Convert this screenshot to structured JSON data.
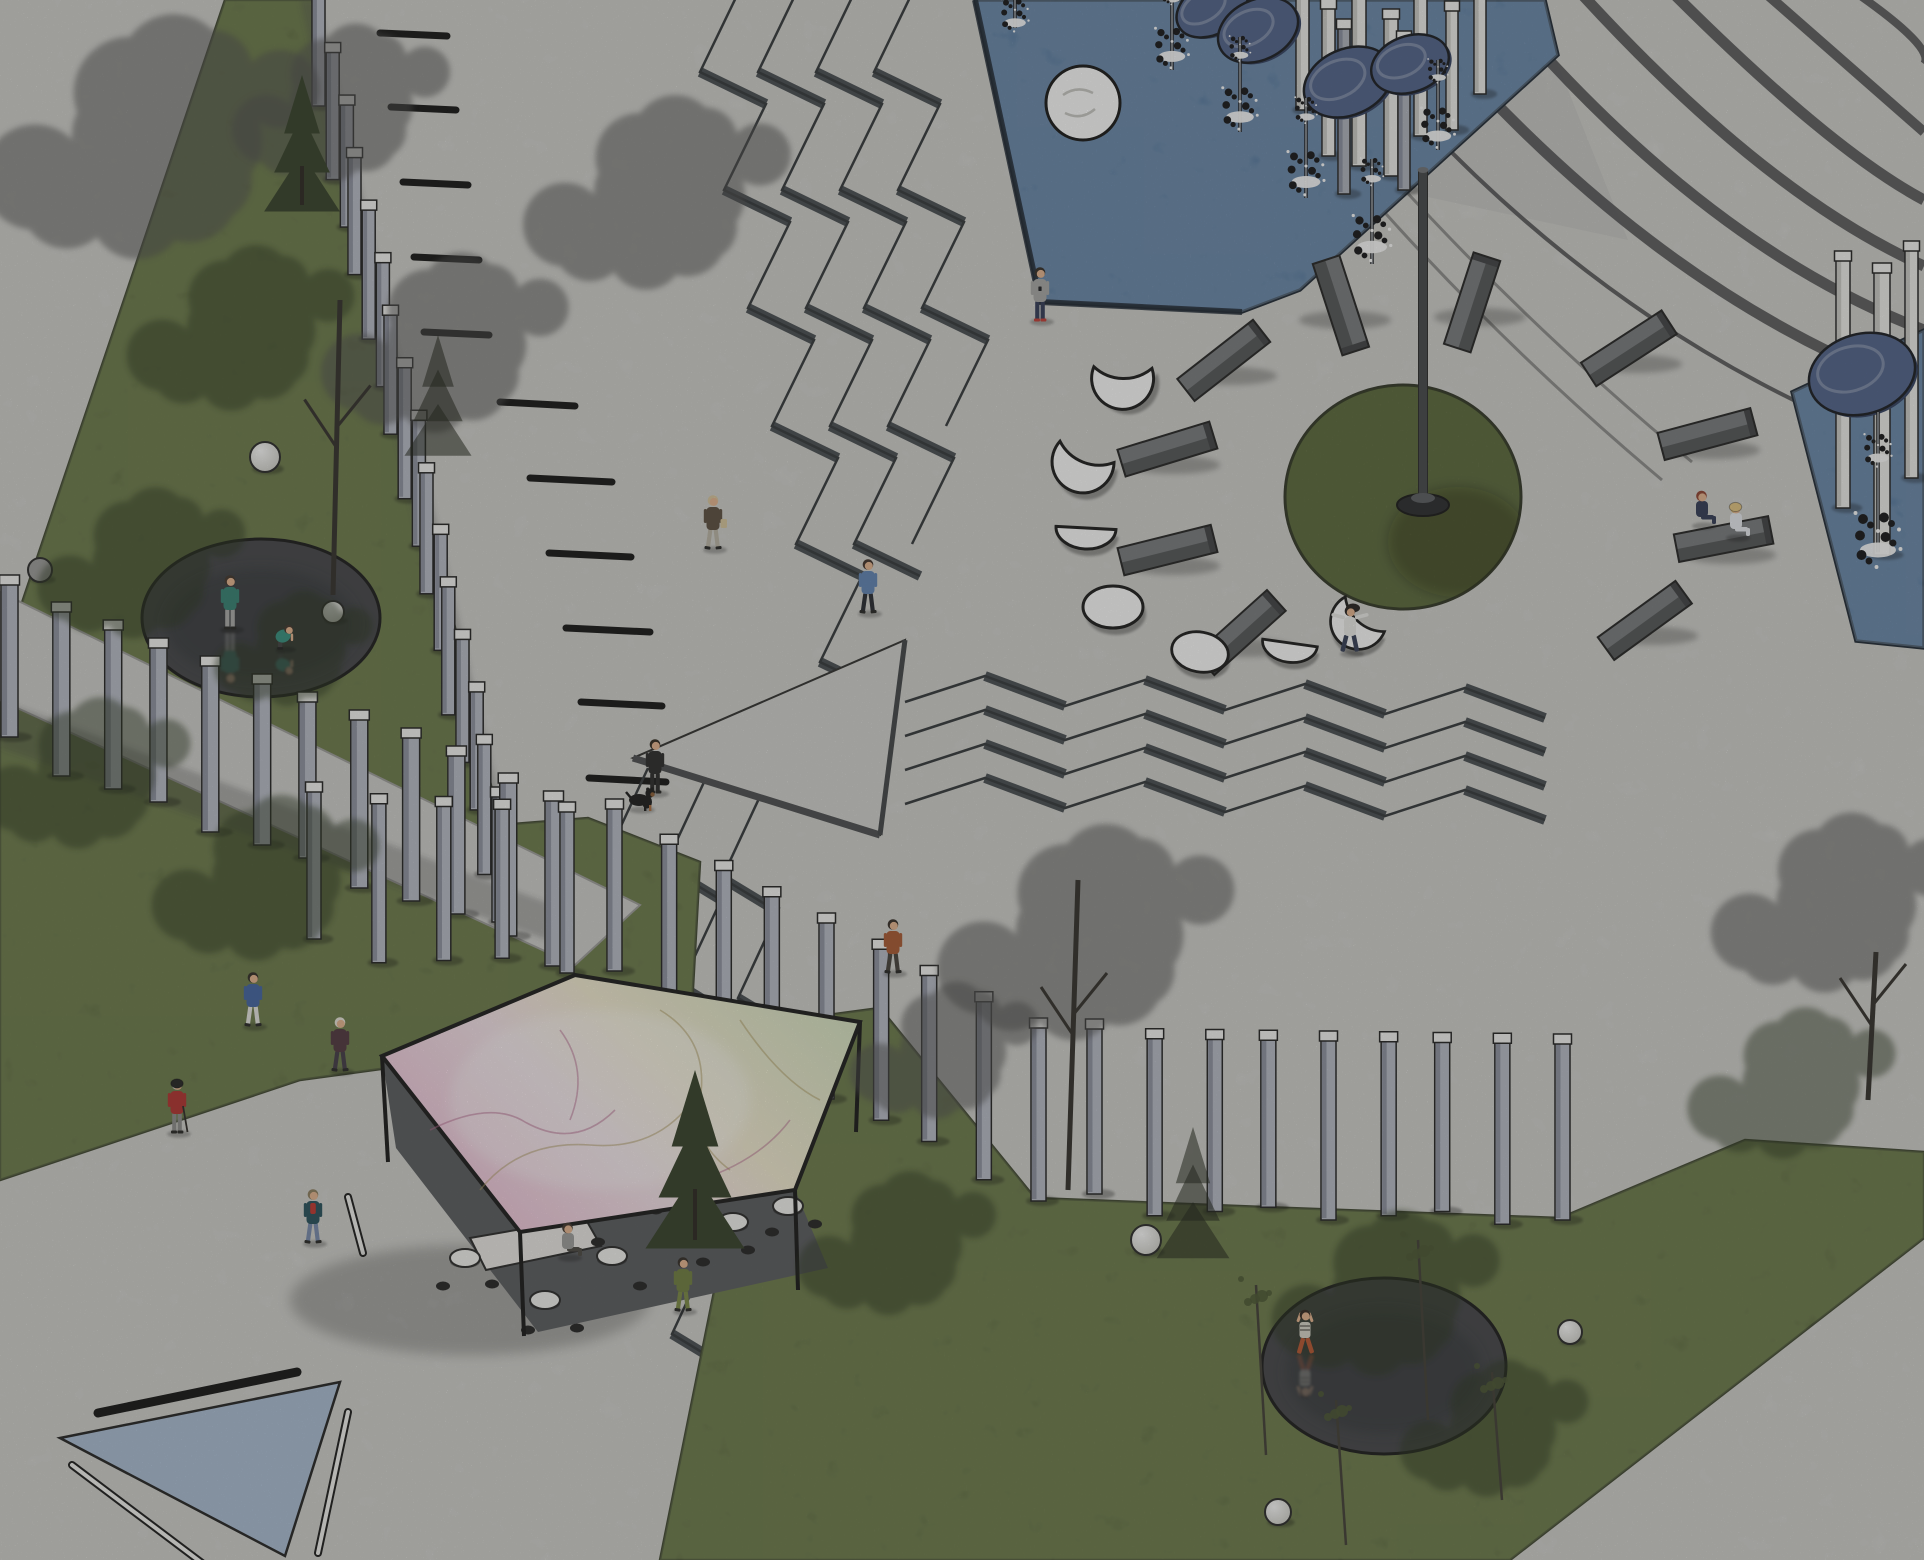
{
  "scene": {
    "title": "Plaza site plan — axonometric illustration",
    "description": "Axonometric architectural rendering of a public plaza: triangular lawns with reflective circular ponds, rows of slab bollards, zig-zag stairs, a blue fountain pool with circular mirrors on posts, a sundial lawn circle with a tall mast surrounded by stone benches and white moon-phase sculptures, and a pentagonal pavilion with an iridescent roof.",
    "canvas": {
      "w": 1924,
      "h": 1560
    }
  },
  "palette": {
    "concrete": "#d9d9d6",
    "concrete_mottle": "#c6c6c2",
    "lawn": "#6f7f49",
    "lawn_dark": "#4e5c34",
    "lawn_edge": "#39402a",
    "pool_blue": "#5780b2",
    "pool_edge": "#18222f",
    "pond_dark": "#3e3f43",
    "pond_edge": "#141414",
    "pillar": "#b7bbc7",
    "pillar_side": "#868b9a",
    "pillar_cap": "#f6f6f4",
    "white_slab": "#efefec",
    "white_slab_side": "#c7c7c3",
    "bench_front": "#4e5052",
    "bench_top": "#75787b",
    "bench_end": "#3a3c3e",
    "moon_white": "#ffffff",
    "outline": "#161616",
    "disc_blue": "#4b5e88",
    "disc_rim": "#2c3a5c",
    "mast": "#3f4144",
    "stair_line": "#2d3135",
    "stair_riser": "#42474c",
    "band_dark": "#4d4d4f",
    "dash_black": "#0d0d0d",
    "roof_pink": "#f1bed8",
    "roof_cream": "#f4ecd2",
    "roof_green": "#d9e5c3",
    "path_band": "#cfcfcc",
    "triangle_blue": "#a9bdd4",
    "skin": "#e7b38c",
    "canopy_gray": "#4a4a48",
    "canopy_green": "#222d14"
  },
  "ground": {
    "lawn_topleft": "225,0 312,0 500,825 588,818 700,862 692,1006 560,1012 432,1062 300,1080 0,1180 0,668",
    "lawn_bottomright": "695,1155 790,1020 880,1008 1035,1198 1290,1208 1560,1218 1745,1140 1924,1152 1924,1238 1510,1560 660,1560 718,1272",
    "lawn_circle": {
      "cx": 1403,
      "cy": 497,
      "rx": 118,
      "ry": 112
    },
    "path_band": "0,592 0,700 575,965 640,905",
    "triangle_blue": "60,1438 340,1382 285,1556",
    "black_bar": [
      98,
      1413,
      297,
      1372
    ],
    "white_rods": [
      [
        348,
        1197,
        363,
        1253
      ],
      [
        318,
        1553,
        348,
        1412
      ],
      [
        72,
        1465,
        210,
        1569
      ]
    ]
  },
  "markings": {
    "dashes": [
      [
        380,
        33,
        447,
        36
      ],
      [
        391,
        107,
        456,
        110
      ],
      [
        403,
        182,
        468,
        185
      ],
      [
        414,
        257,
        479,
        260
      ],
      [
        424,
        332,
        489,
        335
      ],
      [
        500,
        402,
        575,
        406
      ],
      [
        530,
        478,
        612,
        482
      ],
      [
        549,
        553,
        631,
        557
      ],
      [
        566,
        628,
        650,
        632
      ],
      [
        581,
        702,
        662,
        706
      ],
      [
        589,
        778,
        666,
        782
      ],
      [
        597,
        853,
        667,
        857
      ],
      [
        612,
        928,
        681,
        932
      ]
    ],
    "curved_bands": [
      [
        "M1310,-10 Q1570,330 1924,455",
        4
      ],
      [
        "M1395,-10 Q1640,290 1924,392",
        11
      ],
      [
        "M1487,-10 Q1700,245 1924,330",
        11
      ],
      [
        "M1578,-10 Q1765,195 1924,266",
        11
      ],
      [
        "M1670,-10 Q1830,150 1924,200",
        11
      ],
      [
        "M1762,-10 Q1888,100 1924,132",
        10
      ],
      [
        "M1852,-10 Q1936,48 1924,64",
        8
      ]
    ],
    "thin_lines": [
      [
        "M1205,-10 Q1400,260 1662,480",
        3
      ],
      [
        "M1238,-10 Q1430,245 1692,462",
        3
      ]
    ],
    "walkway_shade": "1290,0 1532,0 1628,240 1386,188"
  },
  "stairs": {
    "vertical": [
      [
        [
          742,
          -15
        ],
        [
          700,
          72
        ],
        [
          766,
          104
        ],
        [
          724,
          190
        ],
        [
          790,
          222
        ],
        [
          748,
          308
        ],
        [
          814,
          340
        ],
        [
          772,
          426
        ],
        [
          838,
          458
        ],
        [
          796,
          544
        ],
        [
          862,
          576
        ],
        [
          820,
          662
        ],
        [
          886,
          694
        ]
      ],
      [
        [
          800,
          -15
        ],
        [
          758,
          72
        ],
        [
          824,
          104
        ],
        [
          782,
          190
        ],
        [
          848,
          222
        ],
        [
          806,
          308
        ],
        [
          872,
          340
        ],
        [
          830,
          426
        ],
        [
          896,
          458
        ],
        [
          854,
          544
        ],
        [
          920,
          576
        ]
      ],
      [
        [
          858,
          -15
        ],
        [
          816,
          72
        ],
        [
          882,
          104
        ],
        [
          840,
          190
        ],
        [
          906,
          222
        ],
        [
          864,
          308
        ],
        [
          930,
          340
        ],
        [
          888,
          426
        ],
        [
          954,
          458
        ],
        [
          912,
          544
        ]
      ],
      [
        [
          916,
          -15
        ],
        [
          874,
          72
        ],
        [
          940,
          104
        ],
        [
          898,
          190
        ],
        [
          964,
          222
        ],
        [
          922,
          308
        ],
        [
          988,
          340
        ],
        [
          946,
          426
        ]
      ]
    ],
    "lower_base": [
      [
        648,
        768
      ],
      [
        608,
        854
      ],
      [
        664,
        888
      ],
      [
        624,
        974
      ],
      [
        680,
        1008
      ],
      [
        640,
        1094
      ],
      [
        696,
        1128
      ],
      [
        656,
        1214
      ],
      [
        712,
        1248
      ],
      [
        672,
        1334
      ],
      [
        728,
        1368
      ],
      [
        688,
        1454
      ],
      [
        744,
        1488
      ],
      [
        704,
        1574
      ]
    ],
    "lower_offsets": [
      [
        0,
        0
      ],
      [
        57,
        12
      ],
      [
        114,
        24
      ]
    ],
    "horizontal": {
      "x0": 905,
      "seg": 80,
      "n": 8,
      "amp": 28,
      "drift": 2,
      "lines": [
        688,
        722,
        756,
        790
      ]
    },
    "ramp": "633,758 905,640 880,835"
  },
  "pools": {
    "top": {
      "points": "975,0 1545,0 1558,55 1300,290 1242,312 1040,302",
      "island": {
        "cx": 1083,
        "cy": 103,
        "r": 37
      }
    },
    "right": {
      "points": "1792,392 1924,330 1924,648 1856,641"
    }
  },
  "fountain_jets": [
    [
      1015,
      28,
      46,
      0.9,
      "up"
    ],
    [
      1172,
      70,
      88,
      1.1,
      "up"
    ],
    [
      1240,
      132,
      95,
      1.15,
      "up"
    ],
    [
      1306,
      198,
      100,
      1.2,
      "up"
    ],
    [
      1372,
      264,
      105,
      1.25,
      "up"
    ],
    [
      1438,
      150,
      90,
      1.1,
      "up"
    ],
    [
      1878,
      552,
      140,
      1.5,
      "down"
    ]
  ],
  "discs": [
    [
      1212,
      8,
      38,
      26,
      -30
    ],
    [
      1258,
      30,
      42,
      30,
      -26
    ],
    [
      1348,
      82,
      46,
      33,
      -24
    ],
    [
      1410,
      64,
      40,
      28,
      -20
    ],
    [
      1862,
      374,
      54,
      40,
      -16
    ]
  ],
  "white_slabs": [
    [
      1296,
      -10,
      13,
      120
    ],
    [
      1322,
      6,
      13,
      150
    ],
    [
      1352,
      -6,
      14,
      172
    ],
    [
      1384,
      16,
      14,
      160
    ],
    [
      1414,
      -4,
      13,
      140
    ],
    [
      1446,
      8,
      12,
      122
    ],
    [
      1474,
      -8,
      12,
      102
    ],
    [
      1836,
      258,
      14,
      250
    ],
    [
      1874,
      270,
      16,
      285
    ],
    [
      1905,
      248,
      13,
      230
    ]
  ],
  "gray_slabs": [
    [
      1338,
      26,
      12,
      168
    ],
    [
      1398,
      38,
      12,
      152
    ]
  ],
  "pillar_rows": [
    {
      "name": "row-a",
      "from": [
        315,
        -8
      ],
      "to": [
        492,
        795
      ],
      "count": 16,
      "w": 13,
      "h": 118
    },
    {
      "name": "row-b",
      "from": [
        4,
        586
      ],
      "to": [
        548,
        795
      ],
      "count": 12,
      "w": 17,
      "h": 155
    },
    {
      "name": "row-b2",
      "from": [
        310,
        793
      ],
      "to": [
        560,
        808
      ],
      "count": 5,
      "w": 14,
      "h": 150
    },
    {
      "name": "row-c1",
      "from": [
        610,
        810
      ],
      "to": [
        1028,
        1028
      ],
      "count": 9,
      "w": 15,
      "h": 165
    },
    {
      "name": "row-c2",
      "from": [
        1090,
        1030
      ],
      "to": [
        1552,
        1044
      ],
      "count": 9,
      "w": 15,
      "h": 168
    }
  ],
  "mast": {
    "x": 1423,
    "top": 170,
    "base": 502,
    "w": 9
  },
  "benches": [
    [
      1225,
      362,
      -38
    ],
    [
      1168,
      451,
      -17
    ],
    [
      1168,
      552,
      -14
    ],
    [
      1242,
      634,
      -42
    ],
    [
      1339,
      306,
      72
    ],
    [
      1474,
      303,
      -72
    ],
    [
      1630,
      350,
      -33
    ],
    [
      1708,
      436,
      -15
    ],
    [
      1724,
      541,
      -11
    ],
    [
      1646,
      622,
      -36
    ]
  ],
  "moons": [
    {
      "type": "crescent",
      "x": 1122,
      "y": 368,
      "s": 1.0,
      "rot": -25
    },
    {
      "type": "crescent",
      "x": 1086,
      "y": 452,
      "s": 1.0,
      "rot": -5
    },
    {
      "type": "half",
      "x": 1086,
      "y": 528,
      "s": 1.0,
      "rot": 3
    },
    {
      "type": "full",
      "x": 1113,
      "y": 607,
      "s": 1.0,
      "rot": 0
    },
    {
      "type": "gibbous",
      "x": 1200,
      "y": 652,
      "s": 0.95,
      "rot": 10
    },
    {
      "type": "half",
      "x": 1290,
      "y": 643,
      "s": 0.92,
      "rot": 8
    },
    {
      "type": "crescent",
      "x": 1364,
      "y": 614,
      "s": 0.9,
      "rot": 15
    }
  ],
  "spheres": [
    [
      265,
      457,
      15,
      "#ffffff"
    ],
    [
      333,
      612,
      11,
      "#ffffff"
    ],
    [
      40,
      570,
      12,
      "#9a9a98"
    ],
    [
      1146,
      1240,
      15,
      "#ffffff"
    ],
    [
      1278,
      1512,
      13,
      "#ffffff"
    ],
    [
      1570,
      1332,
      12,
      "#ffffff"
    ]
  ],
  "ponds": [
    {
      "cx": 261,
      "cy": 618,
      "rx": 119,
      "ry": 79
    },
    {
      "cx": 1384,
      "cy": 1366,
      "rx": 122,
      "ry": 88
    }
  ],
  "pavilion": {
    "roof": "575,975 860,1022 795,1190 520,1232 382,1056",
    "interior": "382,1056 520,1232 795,1190 828,1268 538,1332 396,1148",
    "legs": [
      [
        382,
        1056,
        388,
        1162
      ],
      [
        860,
        1022,
        856,
        1132
      ],
      [
        795,
        1190,
        798,
        1290
      ],
      [
        520,
        1232,
        524,
        1336
      ]
    ],
    "counter": "470,1238 585,1218 601,1246 486,1270",
    "tables": [
      [
        465,
        1258
      ],
      [
        545,
        1300
      ],
      [
        612,
        1256
      ],
      [
        676,
        1232
      ],
      [
        733,
        1222
      ],
      [
        788,
        1206
      ]
    ],
    "stools": [
      [
        443,
        1286
      ],
      [
        492,
        1284
      ],
      [
        528,
        1330
      ],
      [
        577,
        1328
      ],
      [
        598,
        1242
      ],
      [
        640,
        1286
      ],
      [
        703,
        1262
      ],
      [
        748,
        1250
      ],
      [
        772,
        1232
      ],
      [
        815,
        1224
      ],
      [
        656,
        1210
      ],
      [
        712,
        1200
      ]
    ],
    "cracks": [
      "M430,1130 q60,-30 95,-8 q50,28 90,-12",
      "M480,1190 q40,-50 110,-45 q60,5 95,-35",
      "M560,1030 q30,40 10,90",
      "M660,1010 q50,30 40,90 q-10,40 30,70",
      "M700,1180 q60,-20 90,-60",
      "M740,1020 q40,60 80,80"
    ]
  },
  "trees": {
    "canopies_gray": [
      [
        165,
        140,
        170
      ],
      [
        350,
        105,
        110
      ],
      [
        455,
        345,
        125
      ],
      [
        668,
        195,
        135
      ],
      [
        1098,
        935,
        150
      ],
      [
        952,
        1052,
        95
      ],
      [
        1845,
        905,
        125
      ]
    ],
    "canopies_green": [
      [
        250,
        330,
        115
      ],
      [
        150,
        565,
        105
      ],
      [
        95,
        775,
        105
      ],
      [
        275,
        880,
        115
      ],
      [
        1395,
        1295,
        115
      ],
      [
        1502,
        1430,
        95
      ],
      [
        1800,
        1085,
        105
      ],
      [
        905,
        1245,
        100
      ],
      [
        300,
        650,
        80
      ]
    ],
    "trunks": [
      [
        333,
        595,
        340,
        300
      ],
      [
        1068,
        1190,
        1078,
        880
      ],
      [
        1868,
        1100,
        1876,
        952
      ]
    ],
    "conifers": [
      [
        302,
        205,
        130,
        "tree"
      ],
      [
        695,
        1240,
        170,
        "tree"
      ],
      [
        438,
        450,
        115,
        "shadow"
      ],
      [
        1193,
        1252,
        125,
        "shadow"
      ]
    ],
    "saplings": [
      [
        1266,
        1455,
        1256,
        1285
      ],
      [
        1428,
        1420,
        1418,
        1240
      ],
      [
        1346,
        1545,
        1336,
        1400
      ],
      [
        1502,
        1500,
        1492,
        1372
      ]
    ]
  },
  "people": [
    {
      "id": "pond-stander",
      "x": 230,
      "y": 608,
      "pose": "stand",
      "top": "#2f7d6f",
      "bottom": "#a9a9a7",
      "hair": "#3a2e26",
      "reflect": true
    },
    {
      "id": "pond-croucher",
      "x": 284,
      "y": 642,
      "pose": "crouch",
      "top": "#2f8d7a",
      "bottom": "#3a3a3a",
      "hair": "#3a2e26",
      "reflect": true,
      "s": 0.85
    },
    {
      "id": "pool-phone-woman",
      "x": 1040,
      "y": 300,
      "pose": "stand",
      "top": "#a6a6a4",
      "bottom": "#2c3552",
      "hair": "#2c2620",
      "shoes": "#c2362e",
      "phone": true
    },
    {
      "id": "coat-shopper",
      "x": 713,
      "y": 528,
      "pose": "walk",
      "top": "#57493a",
      "bottom": "#b9b4a4",
      "hair": "#d9c69c",
      "bag": "#d8c59a"
    },
    {
      "id": "blue-shirt-walker",
      "x": 868,
      "y": 592,
      "pose": "walk",
      "top": "#5b80b4",
      "bottom": "#20222a",
      "hair": "#3a2a22"
    },
    {
      "id": "dog-owner",
      "x": 655,
      "y": 772,
      "pose": "stand",
      "top": "#222222",
      "bottom": "#222222",
      "hair": "#2a2218"
    },
    {
      "id": "red-coat-elder",
      "x": 177,
      "y": 1112,
      "pose": "stand",
      "top": "#b02b28",
      "bottom": "#8a8a88",
      "hair": "#cfcfcd",
      "hat": "#1c1c1c",
      "cane": true
    },
    {
      "id": "plaid-coat-walker",
      "x": 340,
      "y": 1050,
      "pose": "walk",
      "top": "#4a3038",
      "bottom": "#3c3440",
      "hair": "#e9e5da"
    },
    {
      "id": "blue-jacket-walker",
      "x": 253,
      "y": 1005,
      "pose": "walk",
      "top": "#3c5fa0",
      "bottom": "#e6e6e2",
      "hair": "#2a2620"
    },
    {
      "id": "teal-coat-man",
      "x": 313,
      "y": 1222,
      "pose": "walk",
      "top": "#1f4a56",
      "bottom": "#7387ab",
      "hair": "#8a7a5a",
      "accent": "#c03028"
    },
    {
      "id": "olive-visitor",
      "x": 683,
      "y": 1290,
      "pose": "walk",
      "top": "#6b7a3a",
      "bottom": "#77863f",
      "hair": "#2c2620"
    },
    {
      "id": "pavilion-sitter",
      "x": 568,
      "y": 1252,
      "pose": "sit",
      "top": "#9a9a98",
      "bottom": "#44413c",
      "hair": "#3a2f26"
    },
    {
      "id": "rust-jacket-walker",
      "x": 893,
      "y": 952,
      "pose": "walk",
      "top": "#a8542c",
      "bottom": "#3f3a35",
      "hair": "#2e2620"
    },
    {
      "id": "spread-arms-woman",
      "x": 1350,
      "y": 630,
      "pose": "spread",
      "top": "#ececea",
      "bottom": "#2e3750",
      "hair": "#1e1a18"
    },
    {
      "id": "bench-redhead",
      "x": 1702,
      "y": 520,
      "pose": "sit",
      "top": "#2c3550",
      "bottom": "#2c3550",
      "hair": "#8d3b2a"
    },
    {
      "id": "bench-strawhat",
      "x": 1736,
      "y": 532,
      "pose": "sit",
      "top": "#e9ecf2",
      "bottom": "#e9ecf2",
      "hair": "#d8b36a",
      "hat": "#e4c47e"
    },
    {
      "id": "pond-lounger",
      "x": 1305,
      "y": 1332,
      "pose": "lie",
      "top": "#d8d4c8",
      "bottom": "#b5502a",
      "hair": "#2a1f1a",
      "reflect": true
    }
  ],
  "dog": {
    "x": 642,
    "y": 800
  }
}
